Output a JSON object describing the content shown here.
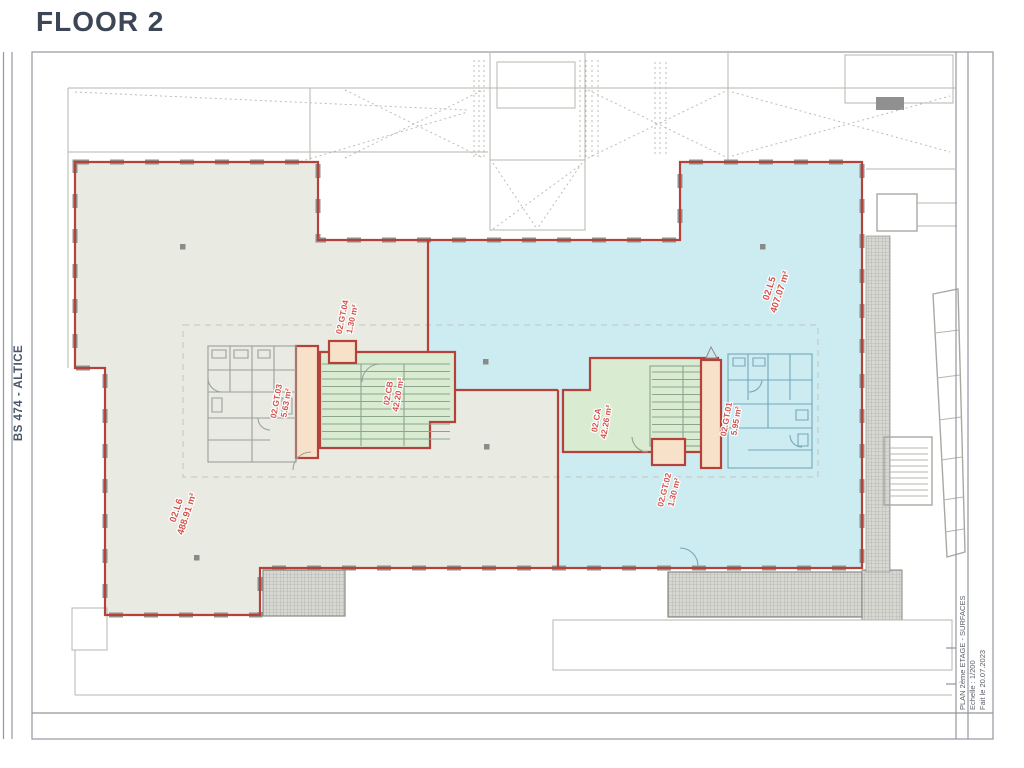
{
  "title": "FLOOR 2",
  "margin": {
    "left_label": "BS 474 - ALTICE"
  },
  "titleblock": {
    "line1": "PLAN 2ème ETAGE - SURFACES",
    "line2": "Echelle : 1/200",
    "line3": "Fait le 20.07.2023"
  },
  "rooms": [
    {
      "id": "02.L6",
      "area": "488.91 m²"
    },
    {
      "id": "02.L5",
      "area": "407.07 m²"
    },
    {
      "id": "02.CB",
      "area": "42.20 m²"
    },
    {
      "id": "02.CA",
      "area": "42.26 m²"
    },
    {
      "id": "02.GT.04",
      "area": "1.30 m²"
    },
    {
      "id": "02.GT.03",
      "area": "5.63 m²"
    },
    {
      "id": "02.GT.01",
      "area": "5.95 m²"
    },
    {
      "id": "02.GT.02",
      "area": "1.30 m²"
    }
  ],
  "colors": {
    "wall_red": "#b4423a",
    "label_red": "#d4544e",
    "plate_beige": "#e9eae2",
    "plate_blue": "#cdecf2",
    "room_green": "#d9ecd2",
    "corridor_peach": "#f7e2c9",
    "title_text": "#3d4656",
    "frame_gray": "#9298a0"
  }
}
